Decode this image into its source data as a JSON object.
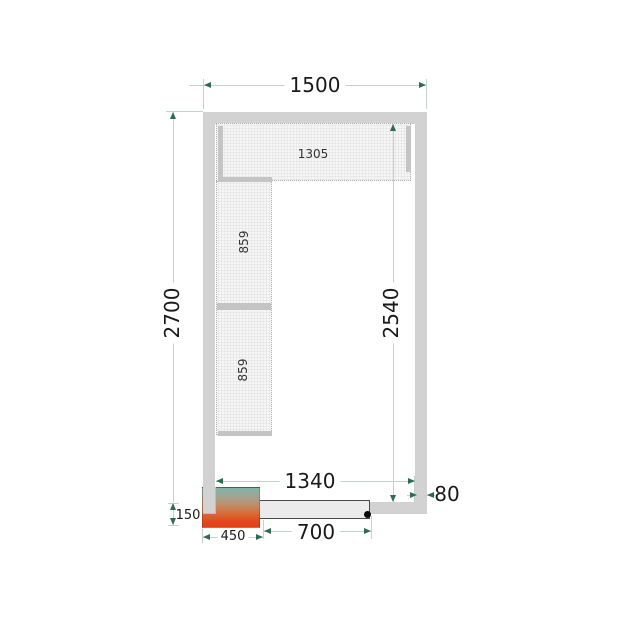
{
  "drawing": {
    "type": "cold-room floor plan, top view",
    "dimensions": {
      "outer_width": "1500",
      "outer_height": "2700",
      "inner_height": "2540",
      "inner_width": "1340",
      "wall_thickness": "80",
      "door_width": "700",
      "unit_width": "450",
      "unit_height": "150"
    },
    "shelves": {
      "top_label": "1305",
      "left_labels": [
        "859",
        "859"
      ]
    },
    "door": {
      "hinge_icon": "hinge-dot"
    },
    "colors": {
      "wall": "#d2d2d2",
      "door_panel": "#ebebeb",
      "door_outline": "#4a4a4a",
      "shelf_fill": "#f6f6f6",
      "shelf_border": "#b0b0b0",
      "shelf_bar": "#c4c4c4",
      "dim_line": "#c3d2cb",
      "dim_arrow": "#2e6b52",
      "text": "#1a1a1a",
      "unit_gradient_top": "#7fb5ac",
      "unit_gradient_bottom": "#e43f14"
    }
  }
}
